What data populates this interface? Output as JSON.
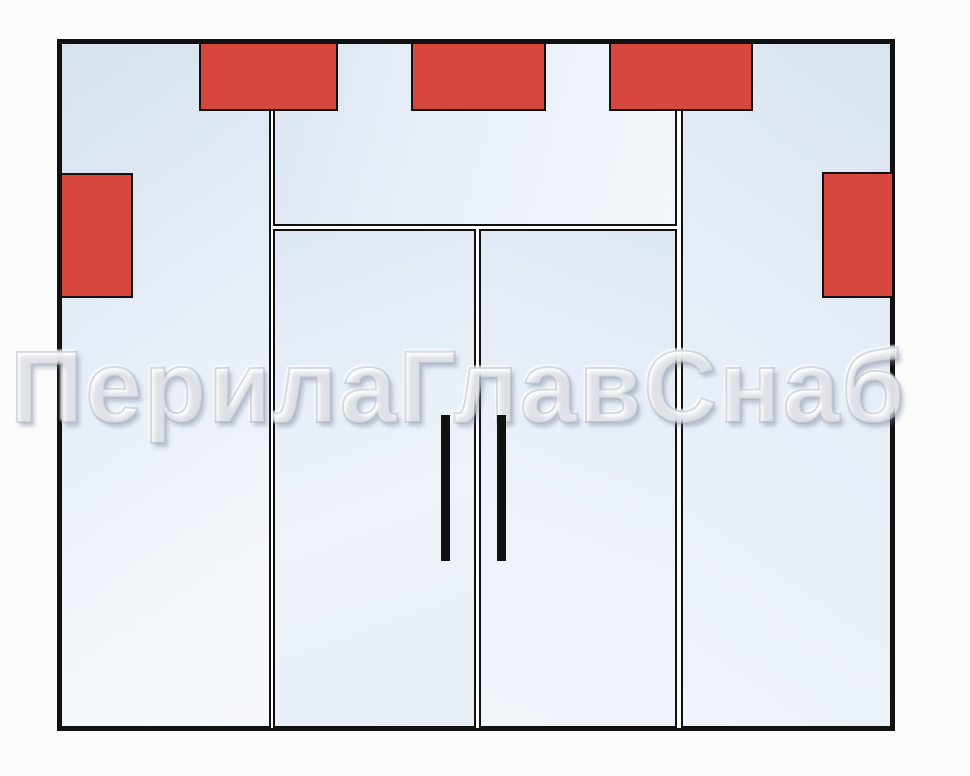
{
  "diagram": {
    "type": "glass-partition-elevation-drawing",
    "watermark": {
      "text": "ПерилаГлавСнаб"
    },
    "panels": [
      {
        "id": "left-sidelight",
        "shape": "glass-panel"
      },
      {
        "id": "transom",
        "shape": "glass-panel"
      },
      {
        "id": "door-left",
        "shape": "glass-door-leaf"
      },
      {
        "id": "door-right",
        "shape": "glass-door-leaf"
      },
      {
        "id": "right-sidelight",
        "shape": "glass-panel"
      }
    ],
    "fittings": [
      {
        "id": "fitting-top-left",
        "shape": "red-rectangle"
      },
      {
        "id": "fitting-top-center",
        "shape": "red-rectangle"
      },
      {
        "id": "fitting-top-right",
        "shape": "red-rectangle"
      },
      {
        "id": "fitting-side-left",
        "shape": "red-rectangle"
      },
      {
        "id": "fitting-side-right",
        "shape": "red-rectangle"
      }
    ],
    "handles": [
      {
        "id": "door-handle-left",
        "shape": "black-vertical-bar"
      },
      {
        "id": "door-handle-right",
        "shape": "black-vertical-bar"
      }
    ]
  },
  "colors": {
    "background": "#fbfbfb",
    "line_black": "#111111",
    "fitting_red": "#d8473e",
    "glass_blue": "#d9e3ef",
    "glass_light": "#f4f8fc",
    "watermark_white": "#ffffff"
  }
}
